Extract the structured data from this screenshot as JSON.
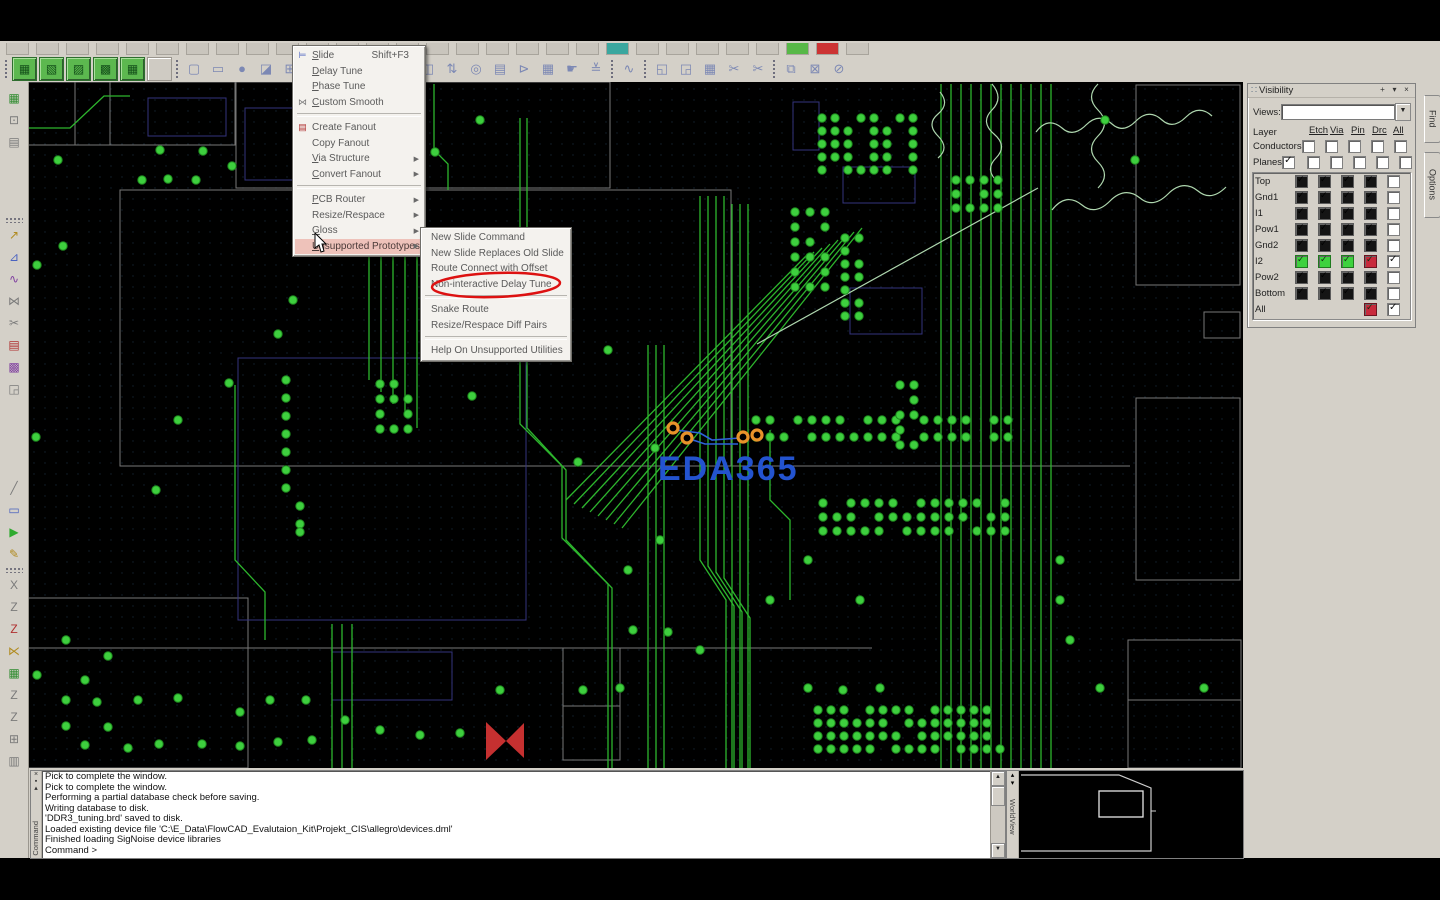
{
  "toolbar": {
    "row1_stub_count": 29,
    "row1_colored": {
      "20": "#3aa79f",
      "26": "#57b847",
      "27": "#cc3333"
    },
    "green_buttons": [
      {
        "name": "green-toolbar-button-1",
        "glyph": "▦"
      },
      {
        "name": "green-toolbar-button-2",
        "glyph": "▧"
      },
      {
        "name": "green-toolbar-button-3",
        "glyph": "▨"
      },
      {
        "name": "green-toolbar-button-4",
        "glyph": "▩"
      },
      {
        "name": "green-toolbar-button-5",
        "glyph": "▦"
      }
    ],
    "mid_icons": [
      {
        "name": "open-icon",
        "glyph": "▢"
      },
      {
        "name": "shape-rect-icon",
        "glyph": "▭"
      },
      {
        "name": "shape-circle-icon",
        "glyph": "●"
      },
      {
        "name": "select-doc-icon",
        "glyph": "◪"
      },
      {
        "name": "grid-icon",
        "glyph": "⊞"
      },
      {
        "name": "rotate-icon",
        "glyph": "↻"
      }
    ],
    "right_icons_a": [
      {
        "name": "pin-spacing-icon",
        "glyph": "⊣"
      },
      {
        "name": "pin-gap-icon",
        "glyph": "⊨"
      }
    ],
    "right_icons_b": [
      {
        "name": "board-edit-icon",
        "glyph": "◧"
      },
      {
        "name": "flip-design-icon",
        "glyph": "◫"
      },
      {
        "name": "highlight-icon",
        "glyph": "⇅"
      },
      {
        "name": "snapshot-icon",
        "glyph": "◎"
      },
      {
        "name": "copy-stack-icon",
        "glyph": "▤"
      },
      {
        "name": "flag-icon",
        "glyph": "⊳"
      },
      {
        "name": "color-grid-icon",
        "glyph": "▦"
      },
      {
        "name": "hand-pick-icon",
        "glyph": "☛"
      },
      {
        "name": "stackup-icon",
        "glyph": "≚"
      }
    ],
    "right_icons_c": [
      {
        "name": "waveform-icon",
        "glyph": "∿"
      }
    ],
    "right_icons_d": [
      {
        "name": "paste-icon",
        "glyph": "◱"
      },
      {
        "name": "clipboard-icon",
        "glyph": "◲"
      },
      {
        "name": "calendar-icon",
        "glyph": "▦"
      },
      {
        "name": "snip-orange-icon",
        "glyph": "✂"
      },
      {
        "name": "snip-icon",
        "glyph": "✂"
      }
    ],
    "right_icons_e": [
      {
        "name": "new-window-icon",
        "glyph": "⧉"
      },
      {
        "name": "mail-icon",
        "glyph": "⊠"
      },
      {
        "name": "help-icon",
        "glyph": "⊘"
      }
    ]
  },
  "left_toolbar": [
    {
      "name": "board-green-icon",
      "glyph": "▦",
      "cls": "c-green",
      "mt": 6
    },
    {
      "name": "xy-coordinate-icon",
      "glyph": "⊡",
      "cls": "c-gray"
    },
    {
      "name": "film-record-icon",
      "glyph": "▤",
      "cls": "c-gray"
    },
    {
      "name": "sep",
      "sep": true,
      "mt": 66
    },
    {
      "name": "add-connect-icon",
      "glyph": "↗",
      "cls": "c-yellow",
      "mt": 2
    },
    {
      "name": "route-edit-icon",
      "glyph": "⊿",
      "cls": "c-blue"
    },
    {
      "name": "delay-tune-icon",
      "glyph": "∿",
      "cls": "c-purple"
    },
    {
      "name": "custom-smooth-icon",
      "glyph": "⋈",
      "cls": "c-gray"
    },
    {
      "name": "slide-icon",
      "glyph": "✂",
      "cls": "c-gray"
    },
    {
      "name": "create-fanout-icon",
      "glyph": "▤",
      "cls": "c-red"
    },
    {
      "name": "color-priority-icon",
      "glyph": "▩",
      "cls": "c-purple"
    },
    {
      "name": "copy-tool-icon",
      "glyph": "◲",
      "cls": "c-gray"
    },
    {
      "name": "line-tool-icon",
      "glyph": "╱",
      "cls": "c-gray",
      "mt": 80
    },
    {
      "name": "rect-tool-icon",
      "glyph": "▭",
      "cls": "c-blue"
    },
    {
      "name": "run-icon",
      "glyph": "▶",
      "cls": "c-green2"
    },
    {
      "name": "probe-icon",
      "glyph": "✎",
      "cls": "c-yellow"
    },
    {
      "name": "sep2",
      "sep": true,
      "mt": 4
    },
    {
      "name": "route-x-icon",
      "glyph": "X",
      "cls": "c-gray",
      "mt": 2
    },
    {
      "name": "route-z1-icon",
      "glyph": "Z",
      "cls": "c-gray"
    },
    {
      "name": "route-z2-icon",
      "glyph": "Z",
      "cls": "c-red"
    },
    {
      "name": "route-mix-icon",
      "glyph": "⋉",
      "cls": "c-yellow"
    },
    {
      "name": "grid-green-icon",
      "glyph": "▦",
      "cls": "c-green"
    },
    {
      "name": "route-z3-icon",
      "glyph": "Z",
      "cls": "c-gray"
    },
    {
      "name": "route-z4-icon",
      "glyph": "Z",
      "cls": "c-gray"
    },
    {
      "name": "measure-icon",
      "glyph": "⊞",
      "cls": "c-gray"
    },
    {
      "name": "table-icon",
      "glyph": "▥",
      "cls": "c-gray"
    }
  ],
  "context_menu": {
    "items": [
      {
        "label": "Slide",
        "u": 0,
        "shortcut": "Shift+F3",
        "icon": "⊨",
        "icon_cls": "c-blue"
      },
      {
        "label": "Delay Tune",
        "u": 0
      },
      {
        "label": "Phase Tune",
        "u": 0
      },
      {
        "label": "Custom Smooth",
        "u": 0,
        "icon": "⋈",
        "icon_cls": "c-gray"
      },
      {
        "sep": true
      },
      {
        "label": "Create Fanout",
        "icon": "▤",
        "icon_cls": "c-red"
      },
      {
        "label": "Copy Fanout"
      },
      {
        "label": "Via Structure",
        "u": 0,
        "arrow": true
      },
      {
        "label": "Convert Fanout",
        "u": 0,
        "arrow": true
      },
      {
        "sep": true
      },
      {
        "label": "PCB Router",
        "u": 0,
        "arrow": true
      },
      {
        "label": "Resize/Respace",
        "arrow": true
      },
      {
        "label": "Gloss",
        "u": 0,
        "arrow": true
      },
      {
        "label": "Unsupported Prototypes",
        "u": 0,
        "arrow": true,
        "highlighted": true
      }
    ]
  },
  "submenu": {
    "items": [
      {
        "label": "New Slide Command"
      },
      {
        "label": "New Slide Replaces Old Slide"
      },
      {
        "label": "Route Connect with Offset"
      },
      {
        "label": "Non-interactive Delay Tune",
        "circled": true
      },
      {
        "sep": true
      },
      {
        "label": "Snake Route"
      },
      {
        "label": "Resize/Respace Diff Pairs"
      },
      {
        "sep": true
      },
      {
        "label": "Help On Unsupported Utilities"
      }
    ]
  },
  "visibility": {
    "title": "Visibility",
    "views_label": "Views:",
    "layer_label": "Layer",
    "columns": [
      "Etch",
      "Via",
      "Pin",
      "Drc",
      "All"
    ],
    "conductors_label": "Conductors",
    "planes_label": "Planes",
    "planes_checked": true,
    "rows": [
      {
        "name": "Top",
        "cells": [
          "dark",
          "dark",
          "dark",
          "dark"
        ],
        "all": false
      },
      {
        "name": "Gnd1",
        "cells": [
          "dark",
          "dark",
          "dark",
          "dark"
        ],
        "all": false
      },
      {
        "name": "I1",
        "cells": [
          "dark",
          "dark",
          "dark",
          "dark"
        ],
        "all": false
      },
      {
        "name": "Pow1",
        "cells": [
          "dark",
          "dark",
          "dark",
          "dark"
        ],
        "all": false
      },
      {
        "name": "Gnd2",
        "cells": [
          "dark",
          "dark",
          "dark",
          "dark"
        ],
        "all": false
      },
      {
        "name": "I2",
        "cells": [
          "green",
          "green",
          "green",
          "red"
        ],
        "all": true
      },
      {
        "name": "Pow2",
        "cells": [
          "dark",
          "dark",
          "dark",
          "dark"
        ],
        "all": false
      },
      {
        "name": "Bottom",
        "cells": [
          "dark",
          "dark",
          "dark",
          "dark"
        ],
        "all": false
      },
      {
        "name": "All",
        "cells": [
          "none",
          "none",
          "none",
          "red"
        ],
        "all": true
      }
    ]
  },
  "right_tabs": [
    {
      "label": "Find",
      "top": 95,
      "h": 46
    },
    {
      "label": "Options",
      "top": 152,
      "h": 64
    }
  ],
  "console": {
    "vertical_label": "Command",
    "lines": [
      "Pick to complete the window.",
      "Pick to complete the window.",
      "Performing a partial database check before saving.",
      "Writing database to disk.",
      "'DDR3_tuning.brd' saved to disk.",
      "Loaded existing device file 'C:\\E_Data\\FlowCAD_Evalutaion_Kit\\Projekt_CIS\\allegro\\devices.dml'",
      "Finished loading SigNoise device libraries",
      "Command >"
    ]
  },
  "worldview": {
    "vertical_label": "WorldView"
  },
  "watermark": {
    "text": "EDA365",
    "color": "#2353cf",
    "pad_color": "#e8932a"
  },
  "canvas": {
    "trace_color": "#2db52d",
    "dot_color": "#3ecf3e",
    "light_color": "#aed6ae",
    "outline_color": "#8c8c8c",
    "purple_color": "#34347e",
    "buses": [
      {
        "x0": 941,
        "count": 12,
        "dx": 10,
        "y1": 84,
        "y2": 768
      },
      {
        "x0": 648,
        "count": 3,
        "dx": 8,
        "y1": 345,
        "y2": 768
      },
      {
        "x0": 332,
        "count": 3,
        "dx": 10,
        "y1": 624,
        "y2": 768
      }
    ],
    "polylines": [
      "700,196 700,560 726,600 726,768",
      "708,196 708,566 734,606 734,768",
      "716,196 716,572 742,612 742,768",
      "724,196 724,578 750,618 750,768",
      "732,204 732,768",
      "740,204 740,768",
      "748,204 748,768",
      "520,118 520,424 562,466 562,538 608,584 608,768",
      "527,118 527,428 566,470 566,540 612,588 612,768",
      "369,232 369,380",
      "381,232 381,392",
      "393,232 393,404",
      "405,232 405,416",
      "417,232 417,428",
      "235,385 235,560 265,592 265,640",
      "434,84 434,150 448,164 448,190",
      "770,430 770,500 790,520 790,600",
      "28,128 70,128 104,96 130,96"
    ],
    "fan_lines": [
      [
        566,
        500,
        806,
        256
      ],
      [
        574,
        504,
        814,
        252
      ],
      [
        582,
        508,
        822,
        248
      ],
      [
        590,
        512,
        830,
        244
      ],
      [
        598,
        516,
        838,
        240
      ],
      [
        606,
        520,
        846,
        236
      ],
      [
        614,
        524,
        854,
        232
      ],
      [
        622,
        528,
        862,
        228
      ]
    ],
    "light_lines": [
      [
        757,
        344,
        1038,
        188
      ]
    ],
    "light_paths": [
      "M992,84 q12,14 0,26 q-12,12 2,24 q14,12 2,24 q-12,12 2,24",
      "M1036,132 q12,-16 26,-4 q11,10 24,-3 q13,-13 26,-1 q11,10 24,-3 q13,-13 26,-1 q11,10 24,-3 q13,-13 26,-1",
      "M1052,210 q14,-18 30,-5 q13,11 28,-4 q15,-15 30,-3 q13,11 28,-4 q15,-15 30,-3 q13,11 28,-4",
      "M1098,84 q-13,13 0,26 q13,13 0,26 q-13,13 0,26 q13,13 0,26",
      "M940,92 q10,12 -2,22 q-12,10 0,22 q12,12 0,22"
    ],
    "gray_rects": [
      [
        28,
        82,
        207,
        63
      ],
      [
        236,
        82,
        374,
        106
      ],
      [
        120,
        190,
        611,
        276
      ],
      [
        1136,
        85,
        104,
        200
      ],
      [
        1204,
        312,
        36,
        26
      ],
      [
        1136,
        398,
        104,
        182
      ],
      [
        1128,
        640,
        113,
        128
      ],
      [
        563,
        648,
        57,
        58
      ],
      [
        563,
        706,
        57,
        54
      ],
      [
        28,
        598,
        220,
        170
      ]
    ],
    "gray_lines": [
      [
        75,
        82,
        75,
        145
      ],
      [
        110,
        82,
        110,
        145
      ],
      [
        28,
        145,
        235,
        145
      ],
      [
        120,
        466,
        1130,
        466
      ],
      [
        28,
        648,
        872,
        648
      ],
      [
        1128,
        700,
        1241,
        700
      ]
    ],
    "purple_rects": [
      [
        148,
        98,
        78,
        38
      ],
      [
        245,
        108,
        66,
        72
      ],
      [
        793,
        102,
        26,
        48
      ],
      [
        843,
        167,
        72,
        36
      ],
      [
        850,
        288,
        72,
        46
      ],
      [
        238,
        358,
        288,
        262
      ],
      [
        332,
        652,
        120,
        48
      ]
    ],
    "clusters": [
      {
        "x": 822,
        "y": 118,
        "cols": 8,
        "rows": 5,
        "dx": 13,
        "dy": 13,
        "skip": [
          2,
          5,
          11,
          14,
          19,
          22,
          27,
          30,
          33,
          38
        ]
      },
      {
        "x": 795,
        "y": 212,
        "cols": 3,
        "rows": 6,
        "dx": 15,
        "dy": 15,
        "skip": [
          4,
          8,
          13
        ]
      },
      {
        "x": 845,
        "y": 238,
        "cols": 2,
        "rows": 7,
        "dx": 14,
        "dy": 13,
        "skip": [
          3,
          9
        ]
      },
      {
        "x": 756,
        "y": 420,
        "cols": 19,
        "rows": 2,
        "dx": 14,
        "dy": 17,
        "skip": [
          2,
          7,
          11,
          16,
          22,
          30,
          35
        ]
      },
      {
        "x": 823,
        "y": 503,
        "cols": 14,
        "rows": 3,
        "dx": 14,
        "dy": 14,
        "skip": [
          1,
          6,
          12,
          17,
          25,
          33,
          38
        ]
      },
      {
        "x": 818,
        "y": 710,
        "cols": 15,
        "rows": 4,
        "dx": 13,
        "dy": 13,
        "skip": [
          3,
          8,
          14,
          21,
          29,
          37,
          44,
          50,
          55
        ]
      },
      {
        "x": 900,
        "y": 385,
        "cols": 2,
        "rows": 5,
        "dx": 14,
        "dy": 15,
        "skip": [
          2,
          7
        ]
      },
      {
        "x": 956,
        "y": 180,
        "cols": 4,
        "rows": 3,
        "dx": 14,
        "dy": 14,
        "skip": [
          5
        ]
      },
      {
        "x": 380,
        "y": 384,
        "cols": 3,
        "rows": 4,
        "dx": 14,
        "dy": 15,
        "skip": [
          2,
          7
        ]
      }
    ],
    "dots": [
      [
        160,
        150
      ],
      [
        203,
        151
      ],
      [
        58,
        160
      ],
      [
        142,
        180
      ],
      [
        168,
        179
      ],
      [
        196,
        180
      ],
      [
        232,
        166
      ],
      [
        306,
        150
      ],
      [
        345,
        155
      ],
      [
        390,
        150
      ],
      [
        435,
        152
      ],
      [
        480,
        120
      ],
      [
        63,
        246
      ],
      [
        37,
        265
      ],
      [
        293,
        300
      ],
      [
        278,
        334
      ],
      [
        608,
        350
      ],
      [
        578,
        462
      ],
      [
        472,
        396
      ],
      [
        229,
        383
      ],
      [
        178,
        420
      ],
      [
        156,
        490
      ],
      [
        36,
        437
      ],
      [
        286,
        380
      ],
      [
        286,
        398
      ],
      [
        286,
        416
      ],
      [
        286,
        434
      ],
      [
        286,
        452
      ],
      [
        286,
        470
      ],
      [
        286,
        488
      ],
      [
        300,
        506
      ],
      [
        300,
        524
      ],
      [
        300,
        532
      ],
      [
        66,
        640
      ],
      [
        108,
        656
      ],
      [
        85,
        680
      ],
      [
        37,
        675
      ],
      [
        66,
        700
      ],
      [
        97,
        702
      ],
      [
        138,
        700
      ],
      [
        178,
        698
      ],
      [
        66,
        726
      ],
      [
        108,
        727
      ],
      [
        85,
        745
      ],
      [
        128,
        748
      ],
      [
        159,
        744
      ],
      [
        202,
        744
      ],
      [
        240,
        746
      ],
      [
        278,
        742
      ],
      [
        312,
        740
      ],
      [
        240,
        712
      ],
      [
        270,
        700
      ],
      [
        306,
        700
      ],
      [
        345,
        720
      ],
      [
        380,
        730
      ],
      [
        420,
        735
      ],
      [
        460,
        733
      ],
      [
        500,
        690
      ],
      [
        583,
        690
      ],
      [
        620,
        688
      ],
      [
        633,
        630
      ],
      [
        668,
        632
      ],
      [
        700,
        650
      ],
      [
        808,
        688
      ],
      [
        843,
        690
      ],
      [
        880,
        688
      ],
      [
        1060,
        600
      ],
      [
        1070,
        640
      ],
      [
        1100,
        688
      ],
      [
        1204,
        688
      ],
      [
        628,
        570
      ],
      [
        660,
        540
      ],
      [
        770,
        600
      ],
      [
        808,
        560
      ],
      [
        860,
        600
      ],
      [
        1060,
        560
      ],
      [
        1105,
        120
      ],
      [
        1135,
        160
      ],
      [
        655,
        448
      ]
    ],
    "bowtie": {
      "p1": "486,722 486,760 506,741",
      "p2": "524,723 524,758 506,741",
      "color": "#c53030"
    },
    "logo": {
      "x": 658,
      "y": 480,
      "pads": [
        [
          673,
          428
        ],
        [
          687,
          438
        ],
        [
          743,
          437
        ],
        [
          757,
          435
        ]
      ],
      "lines": [
        "M676,430 L700,433 712,440 740,438",
        "M690,439 L705,444 738,444"
      ]
    }
  }
}
